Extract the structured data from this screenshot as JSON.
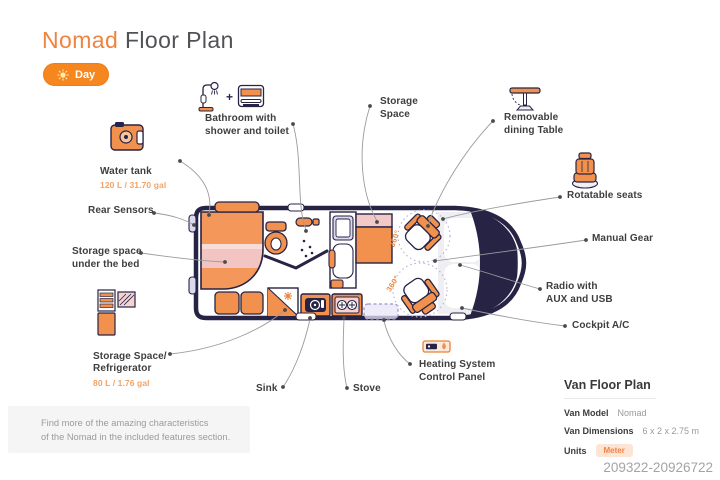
{
  "header": {
    "title_accent": "Nomad",
    "title_rest": " Floor Plan",
    "mode_toggle": {
      "label": "Day",
      "icon": "sun-icon"
    }
  },
  "features": {
    "bathroom": {
      "label": "Bathroom with\nshower and toilet",
      "plus": "+",
      "icons": [
        "shower-icon",
        "toilet-icon"
      ]
    },
    "water_tank": {
      "label": "Water tank",
      "capacity": "120 L / 31.70 gal",
      "icon": "water-tank-icon"
    },
    "rear_sensors": {
      "label": "Rear Sensors"
    },
    "storage_under_bed": {
      "label": "Storage space\nunder the bed"
    },
    "fridge": {
      "label": "Storage Space/\nRefrigerator",
      "capacity": "80 L / 1.76 gal",
      "icon": "refrigerator-icon"
    },
    "sink": {
      "label": "Sink"
    },
    "stove": {
      "label": "Stove"
    },
    "heating": {
      "label": "Heating System\nControl Panel",
      "icon": "heating-panel-icon"
    },
    "storage_space": {
      "label": "Storage\nSpace"
    },
    "dining_table": {
      "label": "Removable\ndining Table",
      "icon": "dining-table-icon"
    },
    "rotatable_seats": {
      "label": "Rotatable seats",
      "icon": "seat-icon"
    },
    "manual_gear": {
      "label": "Manual Gear"
    },
    "radio": {
      "label": "Radio with\nAUX and USB"
    },
    "cockpit_ac": {
      "label": "Cockpit A/C"
    }
  },
  "floor_plan": {
    "seat_rotation": "360°"
  },
  "info_box": {
    "text": "Find more of the amazing characteristics\nof the Nomad in the included features section."
  },
  "van_info": {
    "title": "Van Floor Plan",
    "rows": [
      {
        "key": "Van Model",
        "value": "Nomad"
      },
      {
        "key": "Van Dimensions",
        "value": "6 x 2 x 2.75 m"
      },
      {
        "key": "Units",
        "value": "Meter"
      }
    ]
  },
  "watermark": "209322-20926722",
  "colors": {
    "accent_orange": "#F2873D",
    "fill_orange": "#F2914E",
    "navy": "#272344",
    "pink": "#F3C9C8",
    "lavender": "#DCD8EE",
    "label_text": "#3E3E3E",
    "muted_text": "#9B9B9B"
  }
}
